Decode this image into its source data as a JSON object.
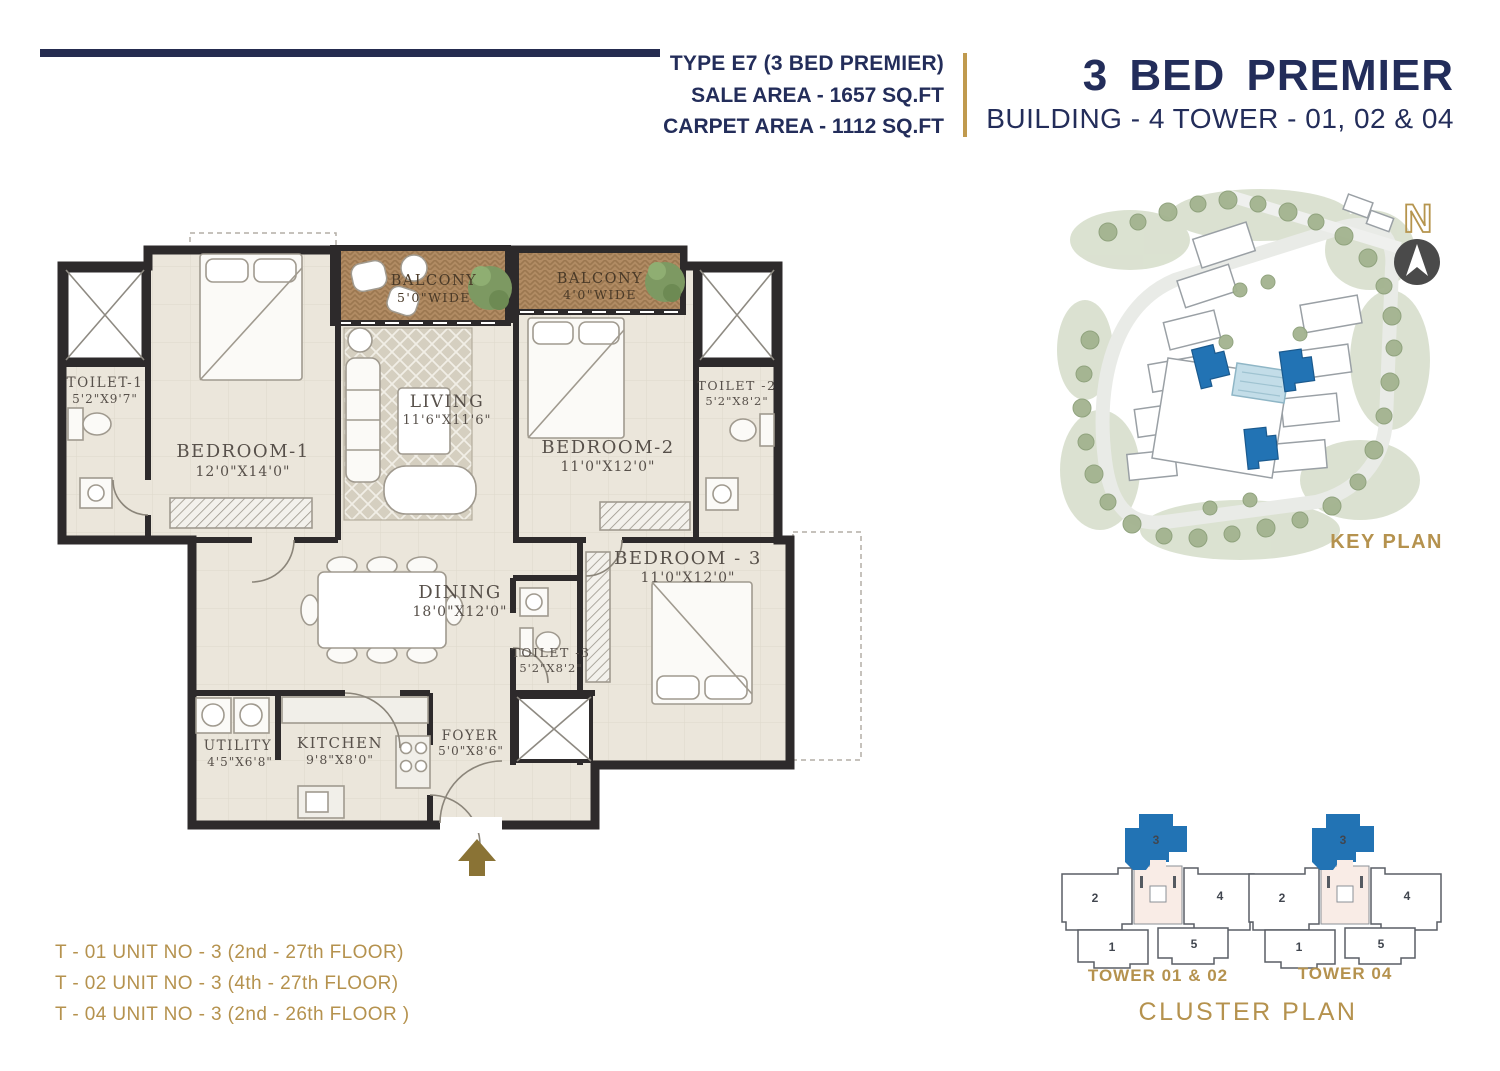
{
  "header": {
    "type_line": "TYPE E7 (3 BED PREMIER)",
    "sale_area": "SALE AREA - 1657 SQ.FT",
    "carpet_area": "CARPET AREA - 1112 SQ.FT",
    "title": "3 BED PREMIER",
    "subtitle": "BUILDING - 4 TOWER - 01, 02 & 04"
  },
  "floor_plan": {
    "rooms": {
      "toilet1": {
        "name": "TOILET-1",
        "dim": "5'2\"X9'7\""
      },
      "bedroom1": {
        "name": "BEDROOM-1",
        "dim": "12'0\"X14'0\""
      },
      "balcony1": {
        "name": "BALCONY",
        "dim": "5'0\"WIDE"
      },
      "living": {
        "name": "LIVING",
        "dim": "11'6\"X11'6\""
      },
      "balcony2": {
        "name": "BALCONY",
        "dim": "4'0\"WIDE"
      },
      "bedroom2": {
        "name": "BEDROOM-2",
        "dim": "11'0\"X12'0\""
      },
      "toilet2": {
        "name": "TOILET -2",
        "dim": "5'2\"X8'2\""
      },
      "bedroom3": {
        "name": "BEDROOM - 3",
        "dim": "11'0\"X12'0\""
      },
      "dining": {
        "name": "DINING",
        "dim": "18'0\"X12'0\""
      },
      "toilet3": {
        "name": "TOILET -3",
        "dim": "5'2\"X8'2\""
      },
      "utility": {
        "name": "UTILITY",
        "dim": "4'5\"X6'8\""
      },
      "kitchen": {
        "name": "KITCHEN",
        "dim": "9'8\"X8'0\""
      },
      "foyer": {
        "name": "FOYER",
        "dim": "5'0\"X8'6\""
      }
    }
  },
  "key_plan": {
    "caption": "KEY PLAN",
    "compass_label": "N"
  },
  "cluster_plan": {
    "caption": "CLUSTER PLAN",
    "towers": [
      {
        "label": "TOWER 01 & 02",
        "units": [
          "1",
          "2",
          "3",
          "4",
          "5"
        ],
        "highlighted_unit": "3"
      },
      {
        "label": "TOWER 04",
        "units": [
          "1",
          "2",
          "3",
          "4",
          "5"
        ],
        "highlighted_unit": "3"
      }
    ]
  },
  "unit_notes": [
    "T - 01 UNIT NO - 3 (2nd - 27th FLOOR)",
    "T - 02 UNIT NO - 3 (4th - 27th FLOOR)",
    "T - 04 UNIT NO - 3 (2nd - 26th FLOOR )"
  ],
  "colors": {
    "navy": "#232d5a",
    "gold": "#b5924e",
    "wall": "#2d2a2b",
    "floor": "#ebe6db",
    "balcony": "#b18b63",
    "highlight_blue": "#2273b4",
    "entry_arrow": "#8a7335"
  }
}
